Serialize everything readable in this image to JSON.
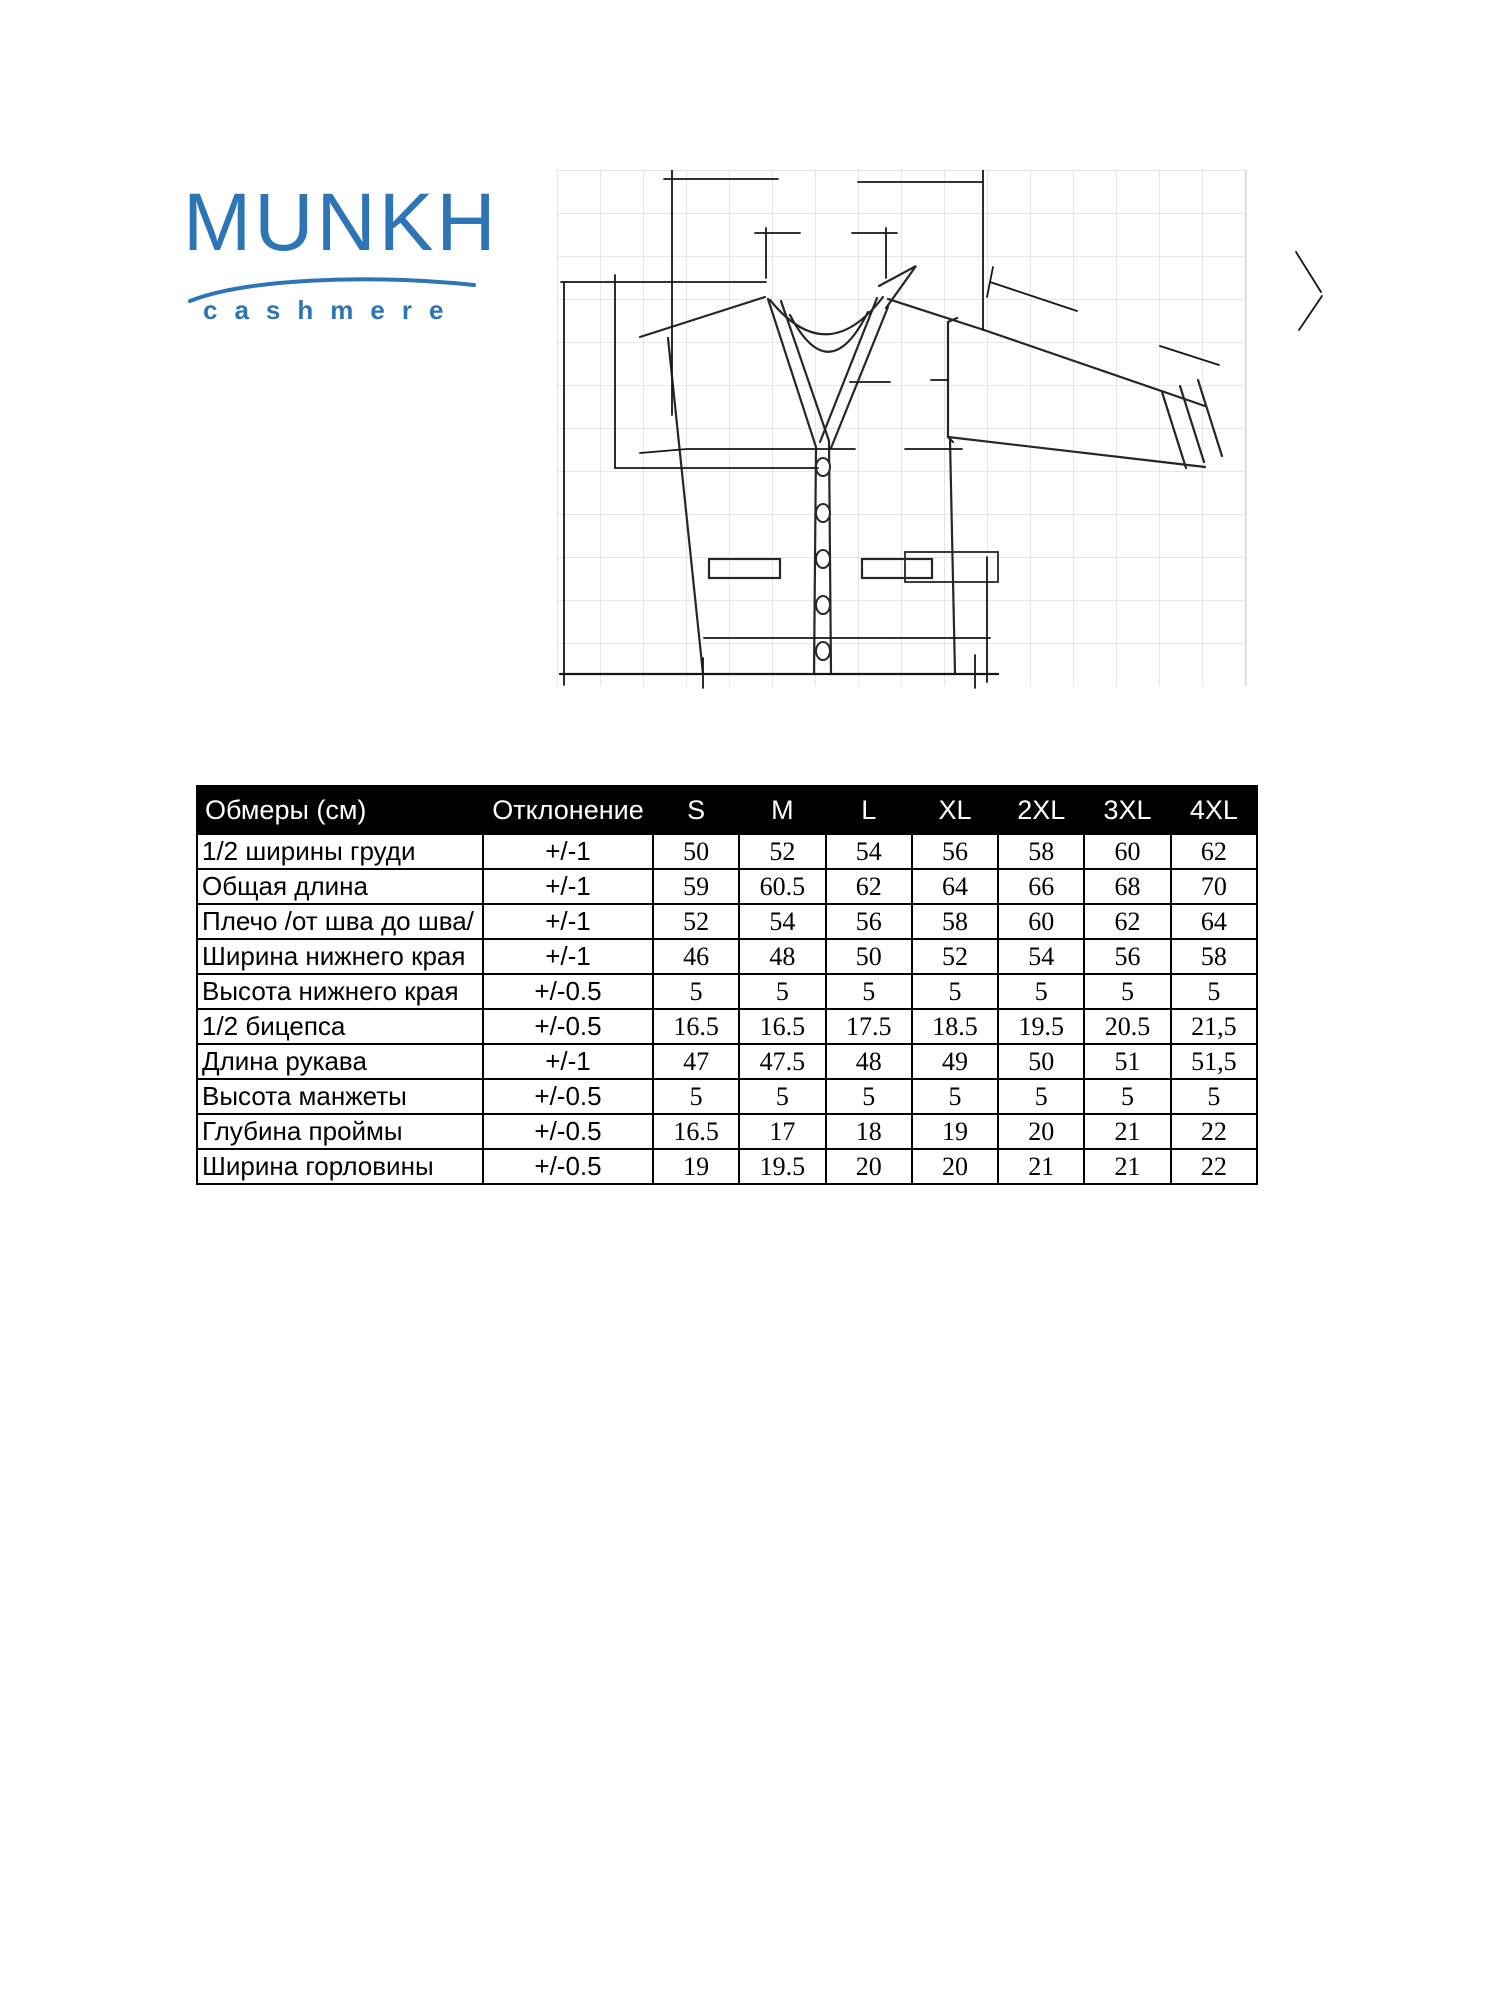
{
  "logo": {
    "brand": "MUNKH",
    "subtitle": "cashmere",
    "color": "#2E75B6"
  },
  "drawing": {
    "subject": "cardigan-flat-sketch-with-dimension-lines",
    "grid_color": "#d9d9d9",
    "line_color": "#262626"
  },
  "table": {
    "headers": [
      "Обмеры (см)",
      "Отклонение",
      "S",
      "M",
      "L",
      "XL",
      "2XL",
      "3XL",
      "4XL"
    ],
    "rows": [
      {
        "label": "1/2 ширины груди",
        "deviation": "+/-1",
        "values": [
          "50",
          "52",
          "54",
          "56",
          "58",
          "60",
          "62"
        ]
      },
      {
        "label": "Общая длина",
        "deviation": "+/-1",
        "values": [
          "59",
          "60.5",
          "62",
          "64",
          "66",
          "68",
          "70"
        ]
      },
      {
        "label": "Плечо /от шва до шва/",
        "deviation": "+/-1",
        "values": [
          "52",
          "54",
          "56",
          "58",
          "60",
          "62",
          "64"
        ]
      },
      {
        "label": "Ширина нижнего края",
        "deviation": "+/-1",
        "values": [
          "46",
          "48",
          "50",
          "52",
          "54",
          "56",
          "58"
        ]
      },
      {
        "label": "Высота нижнего края",
        "deviation": "+/-0.5",
        "values": [
          "5",
          "5",
          "5",
          "5",
          "5",
          "5",
          "5"
        ]
      },
      {
        "label": "1/2 бицепса",
        "deviation": "+/-0.5",
        "values": [
          "16.5",
          "16.5",
          "17.5",
          "18.5",
          "19.5",
          "20.5",
          "21,5"
        ]
      },
      {
        "label": "Длина рукава",
        "deviation": "+/-1",
        "values": [
          "47",
          "47.5",
          "48",
          "49",
          "50",
          "51",
          "51,5"
        ]
      },
      {
        "label": "Высота манжеты",
        "deviation": "+/-0.5",
        "values": [
          "5",
          "5",
          "5",
          "5",
          "5",
          "5",
          "5"
        ]
      },
      {
        "label": "Глубина проймы",
        "deviation": "+/-0.5",
        "values": [
          "16.5",
          "17",
          "18",
          "19",
          "20",
          "21",
          "22"
        ]
      },
      {
        "label": "Ширина горловины",
        "deviation": "+/-0.5",
        "values": [
          "19",
          "19.5",
          "20",
          "20",
          "21",
          "21",
          "22"
        ]
      }
    ]
  }
}
